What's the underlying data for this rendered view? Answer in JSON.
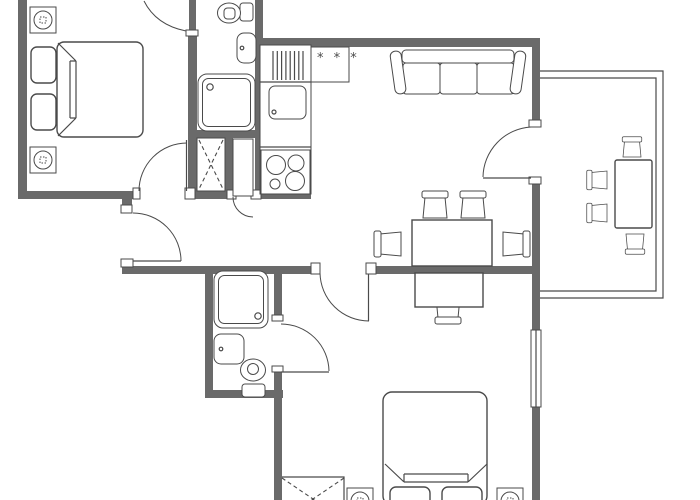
{
  "colors": {
    "background": "#ffffff",
    "wall": "#6a6a6a",
    "line": "#4a4a4a"
  },
  "kitchen": {
    "freezer_label": "* * *"
  },
  "plan": {
    "type": "apartment-floor-plan",
    "rooms": [
      "bedroom-top-left",
      "bathroom-top",
      "entry-hall",
      "kitchen",
      "living-dining-room",
      "balcony",
      "bathroom-bottom",
      "bedroom-bottom"
    ],
    "fixtures": [
      "double-bed",
      "pillow",
      "nightstand-with-lamp",
      "wardrobe-crossed",
      "door-swing",
      "toilet",
      "washbasin",
      "shower-cabin",
      "kitchen-counter-drainer",
      "kitchen-sink",
      "freezer-three-star",
      "cooktop-four-burners",
      "sofa-three-seat",
      "dining-table",
      "chair",
      "desk",
      "desk-chair",
      "balcony-table",
      "balcony-chair",
      "window"
    ]
  }
}
